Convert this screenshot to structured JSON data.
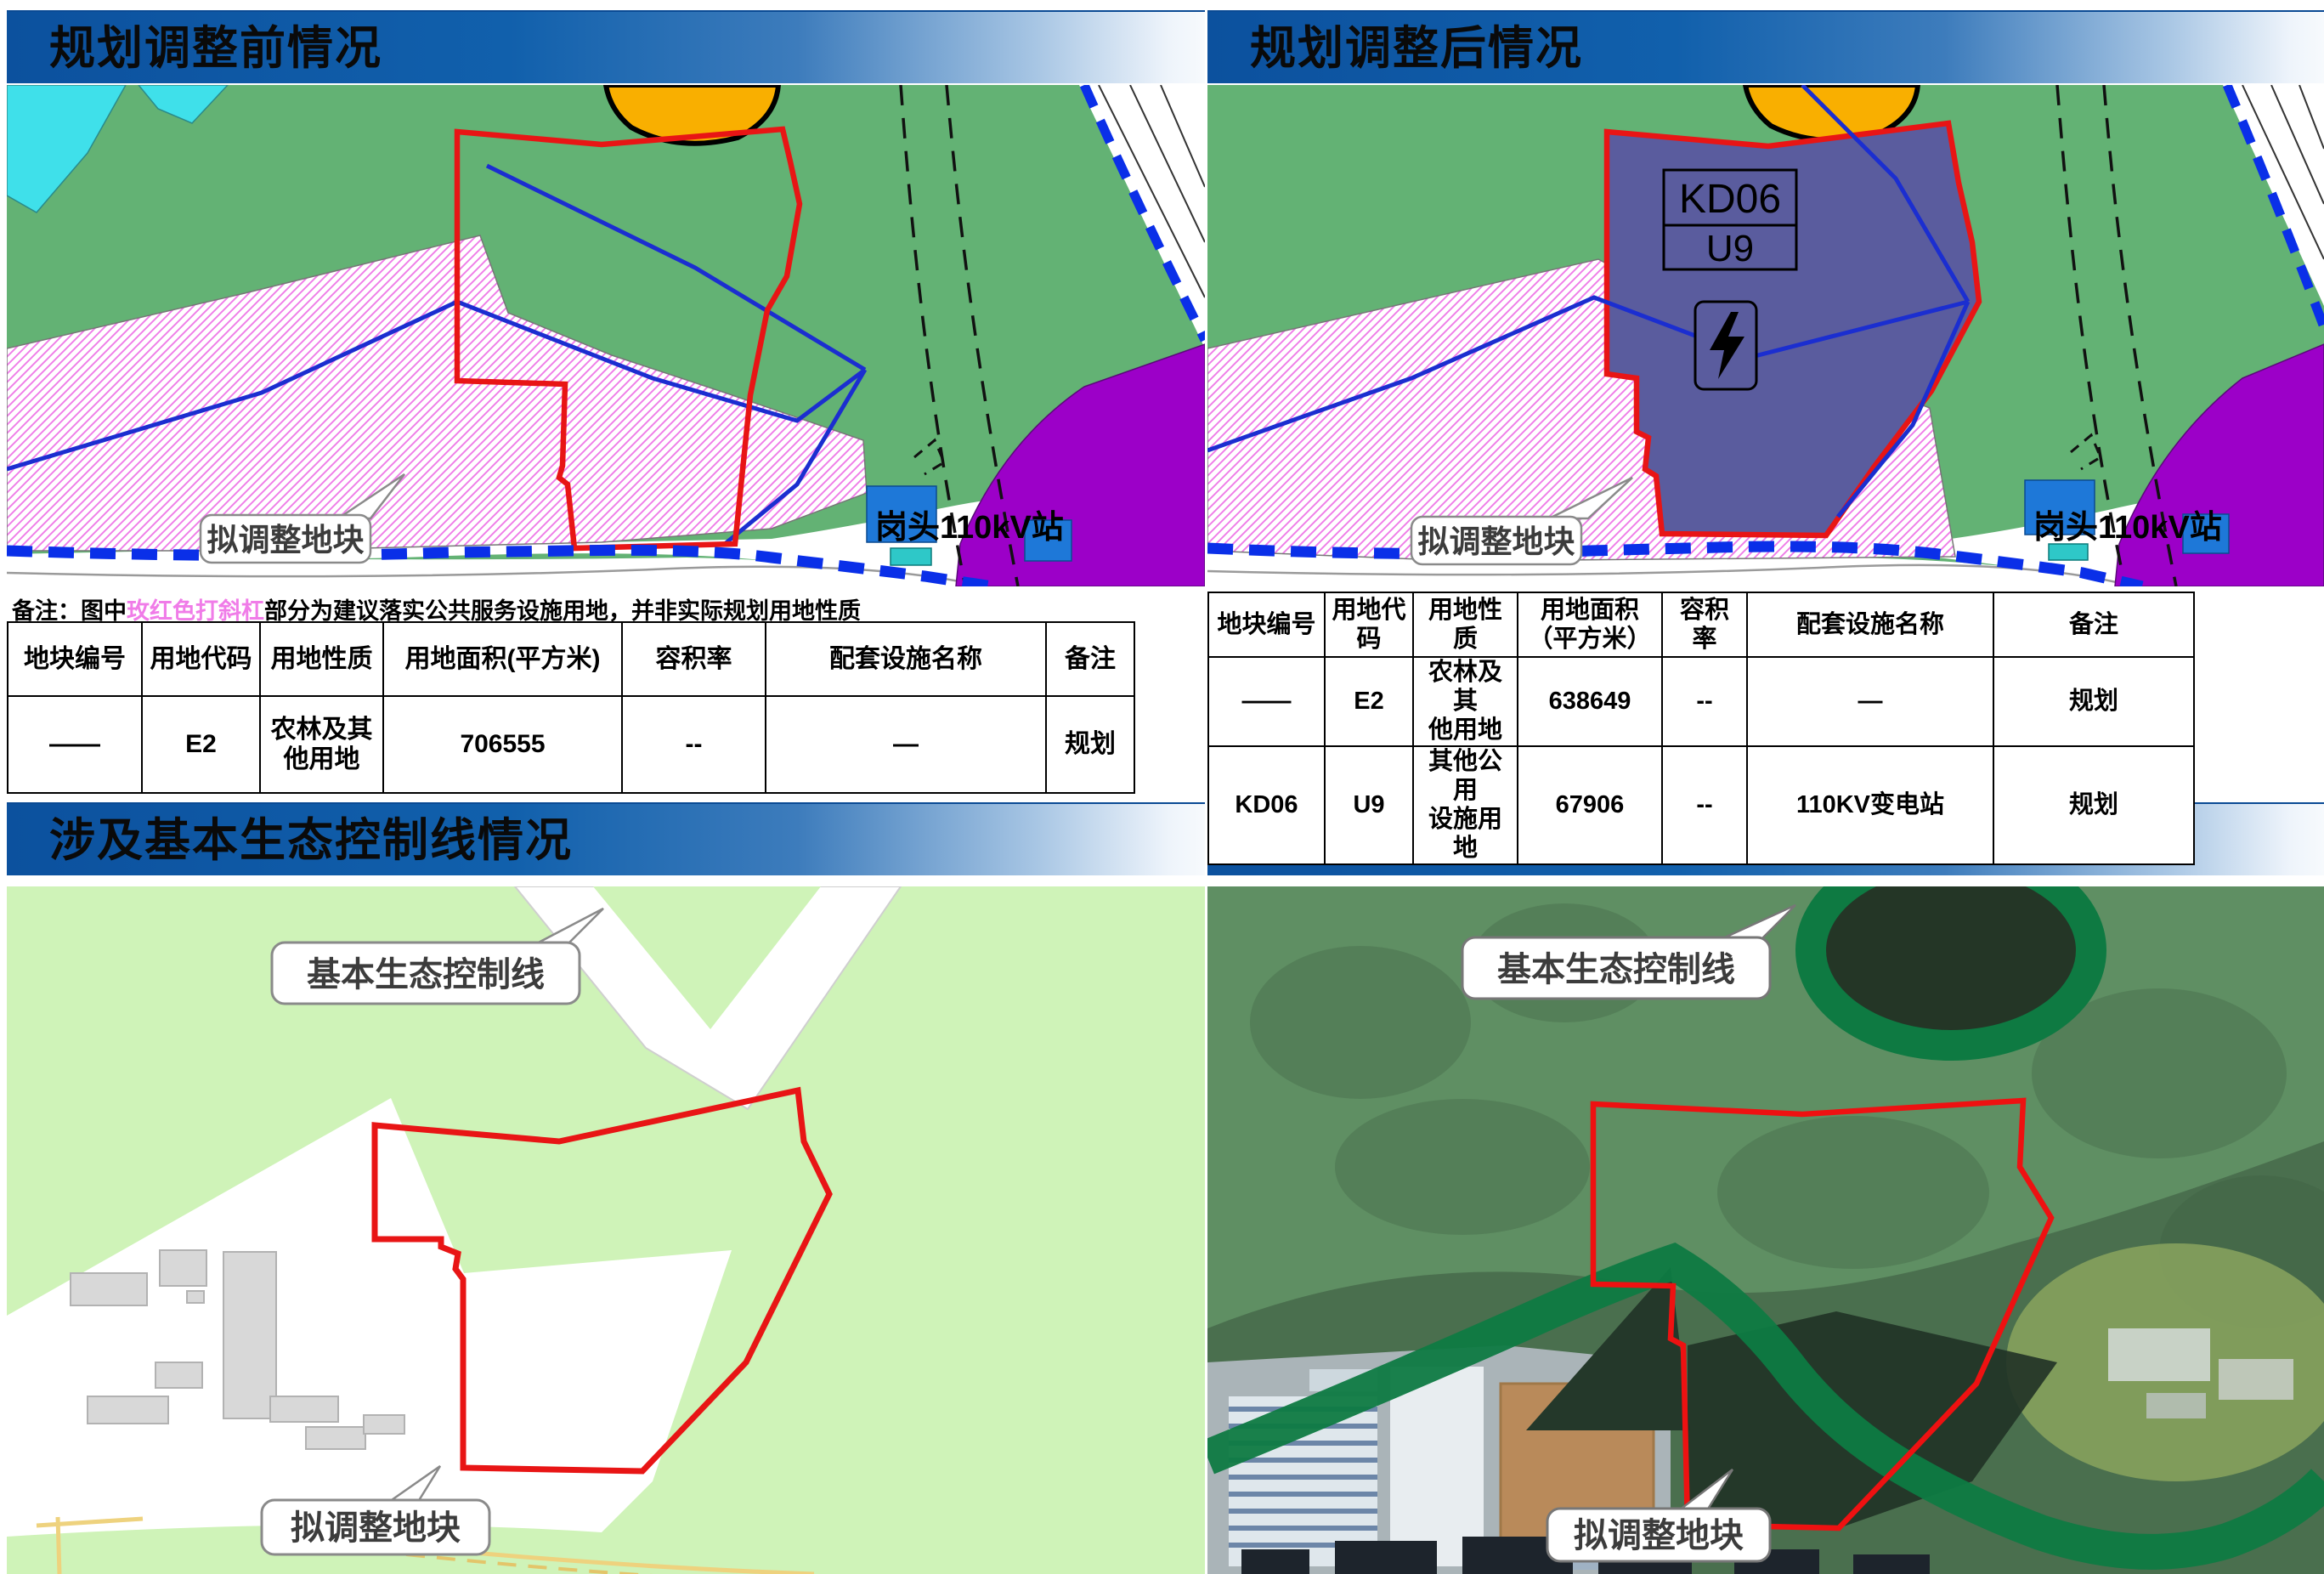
{
  "colors": {
    "header_blue": "#1160ac",
    "map_green": "#63b274",
    "hatch_pink": "#ef7de8",
    "boundary_red": "#e81515",
    "eco_line_blue": "#0a2fe8",
    "parcel_fill_purple": "#5a5c9e",
    "station_purple": "#9c00c8",
    "building_blue": "#1e78d8",
    "water_cyan": "#3fe0ea",
    "eco_light_green": "#cff3b8",
    "eco_band_green": "#0e7a42",
    "orange_parcel": "#f9af00"
  },
  "panels": {
    "before": {
      "title": "规划调整前情况",
      "map": {
        "plot_callout": "拟调整地块",
        "station_label": "岗头110kV站"
      },
      "note": {
        "prefix": "备注：图中",
        "highlight": "玫红色打斜杠",
        "suffix": "部分为建议落实公共服务设施用地，并非实际规划用地性质"
      },
      "table": {
        "headers": [
          "地块编号",
          "用地代码",
          "用地性质",
          "用地面积(平方米)",
          "容积率",
          "配套设施名称",
          "备注"
        ],
        "rows": [
          [
            "——",
            "E2",
            "农林及其\n他用地",
            "706555",
            "--",
            "—",
            "规划"
          ]
        ]
      }
    },
    "after": {
      "title": "规划调整后情况",
      "map": {
        "plot_callout": "拟调整地块",
        "station_label": "岗头110kV站",
        "parcel_code": "KD06",
        "parcel_use_code": "U9"
      },
      "table": {
        "headers": [
          "地块编号",
          "用地代码",
          "用地性质",
          "用地面积\n（平方米）",
          "容积\n率",
          "配套设施名称",
          "备注"
        ],
        "rows": [
          [
            "——",
            "E2",
            "农林及其\n他用地",
            "638649",
            "--",
            "—",
            "规划"
          ],
          [
            "KD06",
            "U9",
            "其他公用\n设施用地",
            "67906",
            "--",
            "110KV变电站",
            "规划"
          ]
        ]
      }
    },
    "eco": {
      "title": "涉及基本生态控制线情况",
      "map": {
        "eco_callout": "基本生态控制线",
        "plot_callout": "拟调整地块"
      }
    },
    "imagery": {
      "title": "影像图",
      "map": {
        "eco_callout": "基本生态控制线",
        "plot_callout": "拟调整地块"
      }
    }
  }
}
